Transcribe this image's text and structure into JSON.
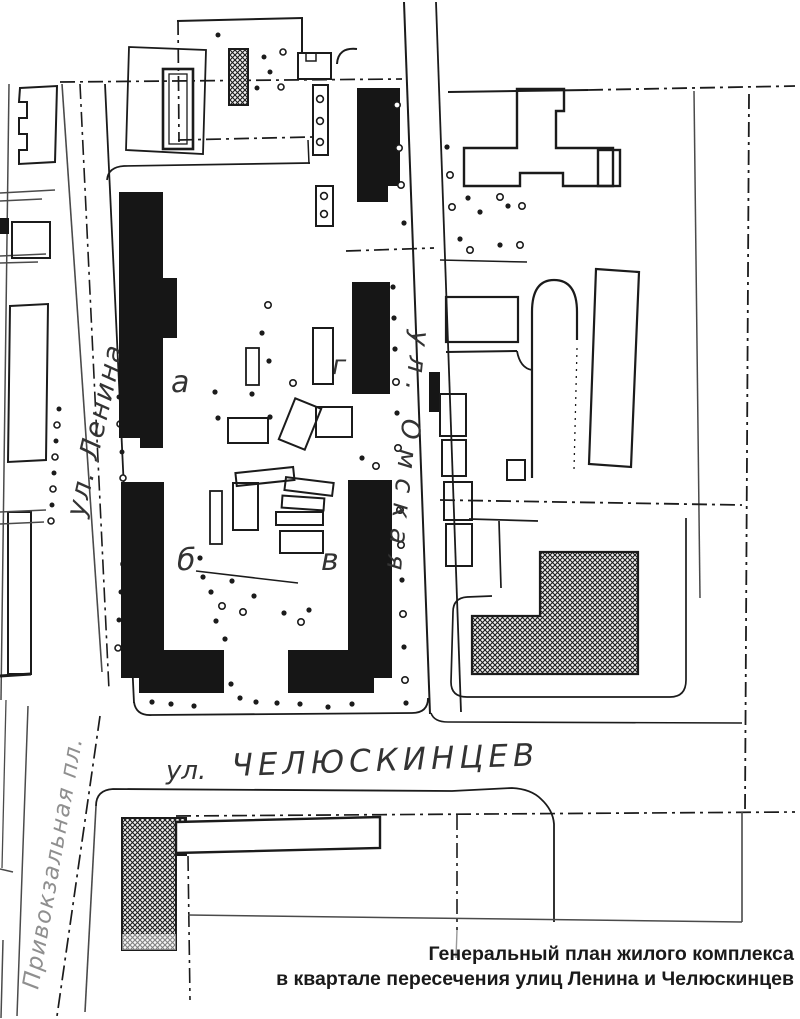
{
  "document": {
    "kind": "general-plan-drawing",
    "caption": {
      "line1": "Генеральный план жилого комплекса",
      "line2": "в квартале пересечения улиц Ленина и Челюскинцев"
    }
  },
  "map": {
    "streets": {
      "lenina": "ул. Ленина",
      "omskaya": "ул. Омская",
      "chelyuskintsev_prefix": "ул.",
      "chelyuskintsev": "ЧЕЛЮСКИНЦЕВ",
      "privokzalnaya": "Привокзальная пл."
    },
    "building_labels": {
      "a": "а",
      "b": "б",
      "v": "в",
      "g": "г"
    }
  },
  "colors": {
    "ink": "#1b1b1b",
    "light_ink": "#8f8f8f",
    "paper": "#ffffff"
  }
}
